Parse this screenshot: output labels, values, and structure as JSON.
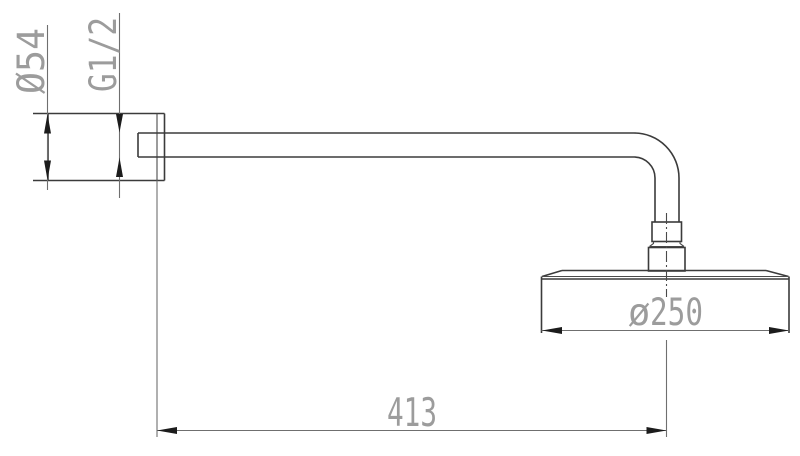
{
  "drawing": {
    "title": "shower-arm-technical-drawing",
    "labels": {
      "flange_diameter": "Ø54",
      "thread_size": "G1/2",
      "head_diameter_symbol": "ø",
      "head_diameter_value": "250",
      "arm_length": "413"
    },
    "colors": {
      "background": "#ffffff",
      "part_outline": "#3b3b3b",
      "dimension_line": "#6f6f6f",
      "arrowhead": "#1c1c1c",
      "dimension_text": "#9c9c9c",
      "dimension_text_dark": "#3d3d3d"
    }
  }
}
